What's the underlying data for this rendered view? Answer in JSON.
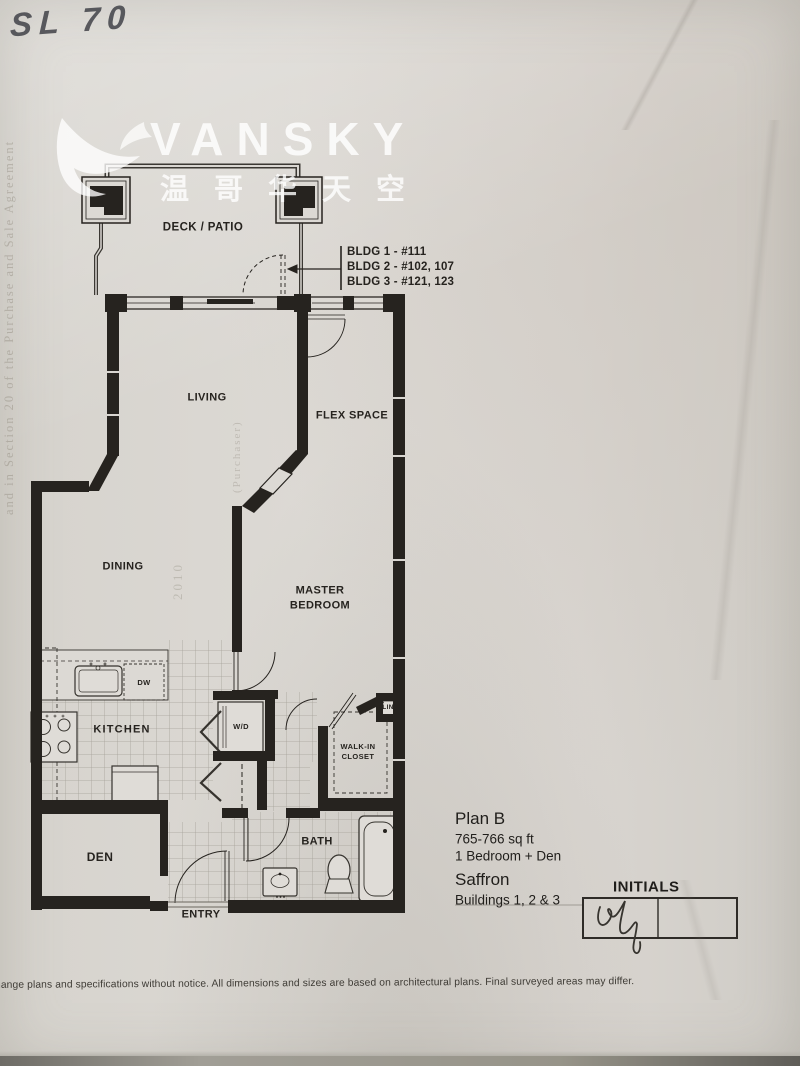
{
  "document": {
    "handwritten_note": "SL 70",
    "disclaimer": "hange plans and specifications without notice.  All dimensions and sizes are based on architectural plans.  Final surveyed areas may differ.",
    "bleed_left": "and in Section 20 of the Purchase and Sale Agreement",
    "bleed_purchaser": "(Purchaser)",
    "bleed_year": "2010"
  },
  "watermark": {
    "brand": "VANSKY",
    "chinese": "温哥华天空"
  },
  "floorplan": {
    "bldg": [
      "BLDG 1 - #111",
      "BLDG 2 - #102, 107",
      "BLDG 3 - #121, 123"
    ],
    "rooms": {
      "deck": "DECK / PATIO",
      "living": "LIVING",
      "flex": "FLEX SPACE",
      "dining": "DINING",
      "master": "MASTER\nBEDROOM",
      "kitchen": "KITCHEN",
      "den": "DEN",
      "bath": "BATH",
      "entry": "ENTRY",
      "walkin": "WALK-IN\nCLOSET",
      "wd": "W/D",
      "dw": "DW",
      "lin": "LIN"
    }
  },
  "plan_info": {
    "plan_name": "Plan B",
    "area": "765-766 sq ft",
    "layout": "1 Bedroom + Den",
    "project": "Saffron",
    "buildings": "Buildings 1, 2 & 3",
    "initials_label": "INITIALS"
  }
}
